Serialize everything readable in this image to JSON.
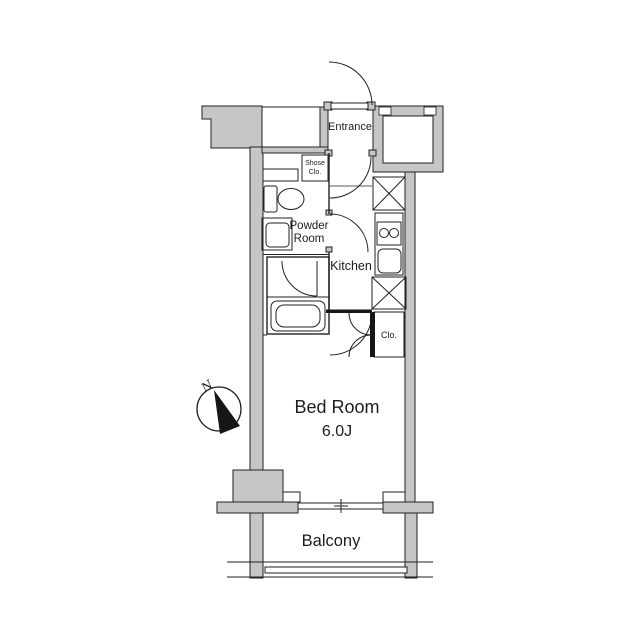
{
  "rooms": {
    "entrance": {
      "label": "Entrance"
    },
    "shoes_closet": {
      "line1": "Shose",
      "line2": "Clo."
    },
    "powder_room": {
      "line1": "Powder",
      "line2": "Room"
    },
    "kitchen": {
      "label": "Kitchen"
    },
    "closet": {
      "label": "Clo."
    },
    "bedroom": {
      "label": "Bed Room",
      "size": "6.0J"
    },
    "balcony": {
      "label": "Balcony"
    }
  },
  "compass": {
    "north_label": "N"
  },
  "colors": {
    "wall_fill": "#c6c6c6",
    "line": "#222222",
    "background": "#ffffff"
  }
}
